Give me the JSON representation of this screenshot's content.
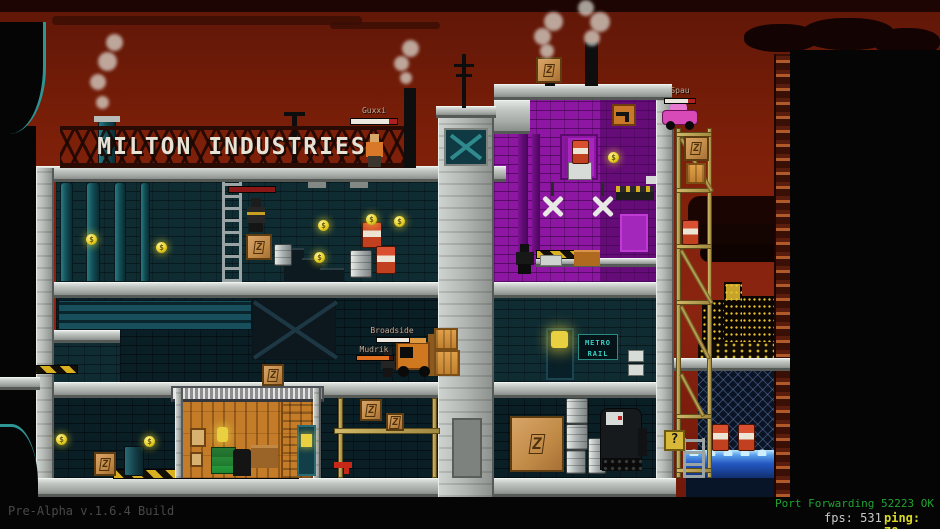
{
  "hud": {
    "build_label": "Pre-Alpha v.1.6.4 Build",
    "port_status": "Port Forwarding 52223 OK",
    "fps_label": "fps:",
    "fps_value": "531",
    "ping_label": "ping:",
    "ping_value": "78"
  },
  "signs": {
    "building_sign": "MILTON INDUSTRIES",
    "metro_sign_line1": "METRO",
    "metro_sign_line2": "RAIL",
    "mystery_box_sign": "?",
    "crate_mark": "Z",
    "coin_symbol": "$"
  },
  "players": [
    {
      "name": "Guxxi",
      "hp_percent": 82
    },
    {
      "name": "Spau",
      "hp_percent": 78
    },
    {
      "name": "Broadside",
      "hp_percent": 100
    },
    {
      "name": "Mudrik",
      "hp_percent": 90
    }
  ],
  "colors": {
    "sky_red": "#7e2009",
    "brick_teal": "#0f2c33",
    "purple_room": "#8d16a2",
    "concrete_gray": "#b5b9b5",
    "hazard_yellow": "#d8b020",
    "water_glow": "#9adcf8",
    "coin_gold": "#e8d020",
    "port_status_green": "#21a332",
    "ping_yellow": "#d8d828",
    "health_white": "#ece8e0",
    "health_orange": "#e07020"
  }
}
